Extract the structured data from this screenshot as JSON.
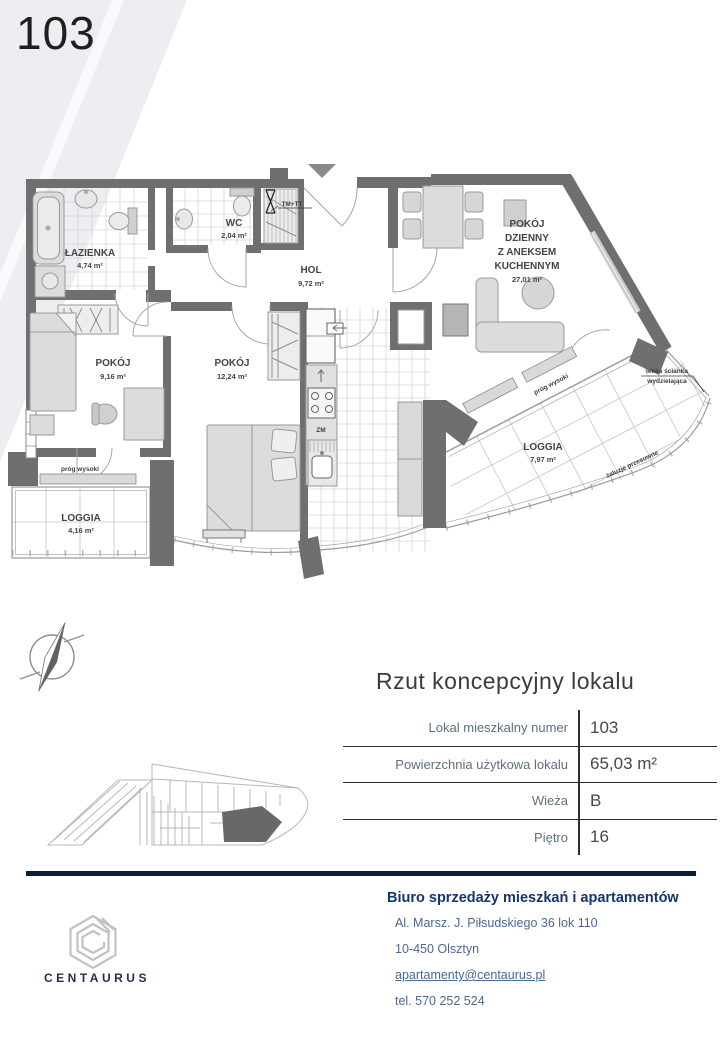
{
  "page": {
    "unit_number": "103"
  },
  "plan": {
    "rooms": {
      "lazienka": {
        "name": "ŁAZIENKA",
        "area": "4,74 m²"
      },
      "wc": {
        "name": "WC",
        "area": "2,04 m²"
      },
      "hol": {
        "name": "HOL",
        "area": "9,72 m²"
      },
      "pokoj_a": {
        "name": "POKÓJ",
        "area": "9,16 m²"
      },
      "pokoj_b": {
        "name": "POKÓJ",
        "area": "12,24 m²"
      },
      "pokoj_dzienny": {
        "lines": [
          "POKÓJ",
          "DZIENNY",
          "Z ANEKSEM",
          "KUCHENNYM"
        ],
        "area": "27,01 m²"
      },
      "loggia_a": {
        "name": "LOGGIA",
        "area": "4,16 m²"
      },
      "loggia_b": {
        "name": "LOGGIA",
        "area": "7,97 m²"
      }
    },
    "annotations": {
      "prog_wysoki": "próg wysoki",
      "zaluzje": "żaluzje przesuwne",
      "lekka_scianka_1": "lekka ścianka",
      "lekka_scianka_2": "wydzielająca",
      "tm_tt": "TM+TT",
      "zm": "ZM"
    }
  },
  "details": {
    "title": "Rzut koncepcyjny lokalu",
    "rows": [
      {
        "label": "Lokal mieszkalny numer",
        "value": "103"
      },
      {
        "label": "Powierzchnia użytkowa lokalu",
        "value": "65,03 m²"
      },
      {
        "label": "Wieża",
        "value": "B"
      },
      {
        "label": "Piętro",
        "value": "16"
      }
    ]
  },
  "footer": {
    "brand": "CENTAURUS",
    "office_title": "Biuro sprzedaży mieszkań i apartamentów",
    "address_line1": "Al. Marsz. J. Piłsudskiego 36 lok 110",
    "address_line2": "10-450 Olsztyn",
    "email": "apartamenty@centaurus.pl",
    "phone": "tel. 570 252 524"
  },
  "colors": {
    "accent_navy": "#0d1c38",
    "contact_blue": "#4c688f",
    "table_label_gray": "#5f6f7f",
    "wall_gray": "#6f6f6f"
  }
}
